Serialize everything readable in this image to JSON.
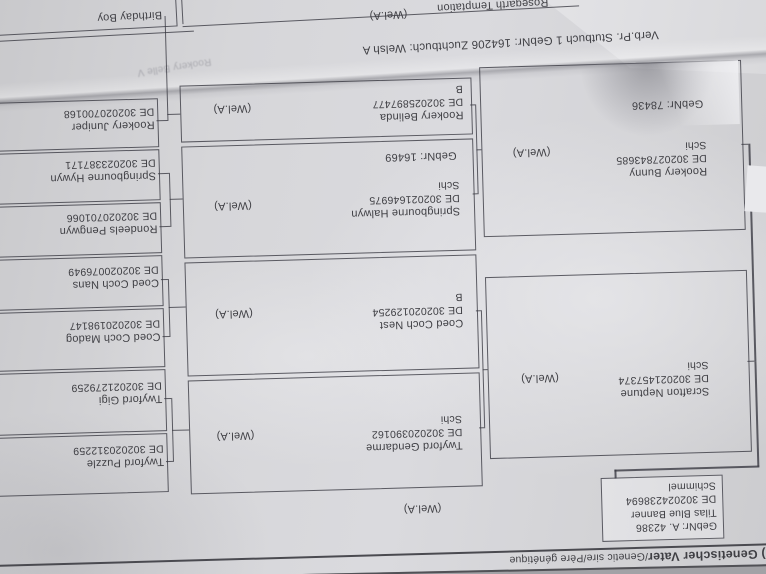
{
  "document_kind": "photographed pedigree page, printed upside-down in the photo",
  "colors": {
    "paper": "#d6d6d9",
    "ink": "#3f3f44",
    "photo_edge": "#a2a2a6"
  },
  "top": {
    "cut_name": "Birthday Boy",
    "wel": "(Wel.A)",
    "dam": {
      "name": "Rosegarth Temptation",
      "reg": "GBR046020164206",
      "color": "Rappe"
    },
    "info_line": "Verb.Pr.  Stutbuch 1    GebNr:  164206    Zuchtbuch:  Welsh A",
    "bleed": "Rookery Belle V"
  },
  "ped": {
    "gen1": {
      "gebnr": "GebNr:  A. 42386",
      "name": "Tilas Blue Banner",
      "reg": "DE 302024238694",
      "color": "Schimmel",
      "wel": "(Wel.A)"
    },
    "gen2": [
      {
        "gebnr": "GebNr:  78436",
        "name": "Rookery Bunny",
        "reg": "DE 302027843685",
        "code": "Schi",
        "wel": "(Wel.A)"
      },
      {
        "name": "Scrafton Neptune",
        "reg": "DE 302021457374",
        "code": "Schi",
        "wel": "(Wel.A)"
      }
    ],
    "gen3": [
      {
        "name": "Rookery Belinda",
        "reg": "DE 302025897477",
        "code": "B",
        "wel": "(Wel.A)"
      },
      {
        "gebnr": "GebNr:  16469",
        "name": "Springbourne Halwyn",
        "reg": "DE 302021646975",
        "code": "Schi",
        "wel": "(Wel.A)"
      },
      {
        "name": "Coed Coch Nest",
        "reg": "DE 302020129254",
        "code": "B",
        "wel": "(Wel.A)"
      },
      {
        "name": "Twyford Gendarme",
        "reg": "DE 302020390162",
        "code": "Schi",
        "wel": "(Wel.A)"
      }
    ],
    "gen4": [
      {
        "name": "Rookery Juniper",
        "reg": "DE 302020700168"
      },
      {
        "name": "Springbourne Hywyn",
        "reg": "DE 302023387171"
      },
      {
        "name": "Rondeels Pengwyn",
        "reg": "DE 302020701066"
      },
      {
        "name": "Coed Coch Nans",
        "reg": "DE 302020076949"
      },
      {
        "name": "Coed Coch Madog",
        "reg": "DE 302020198147"
      },
      {
        "name": "Twyford Gigi",
        "reg": "DE 302021279259"
      },
      {
        "name": "Twyford Puzzle",
        "reg": "DE 302020312259"
      }
    ]
  },
  "footer": {
    "title_bold": "5) Genetischer Vater",
    "title_rest": "/Genetic sire/Père génétique"
  }
}
